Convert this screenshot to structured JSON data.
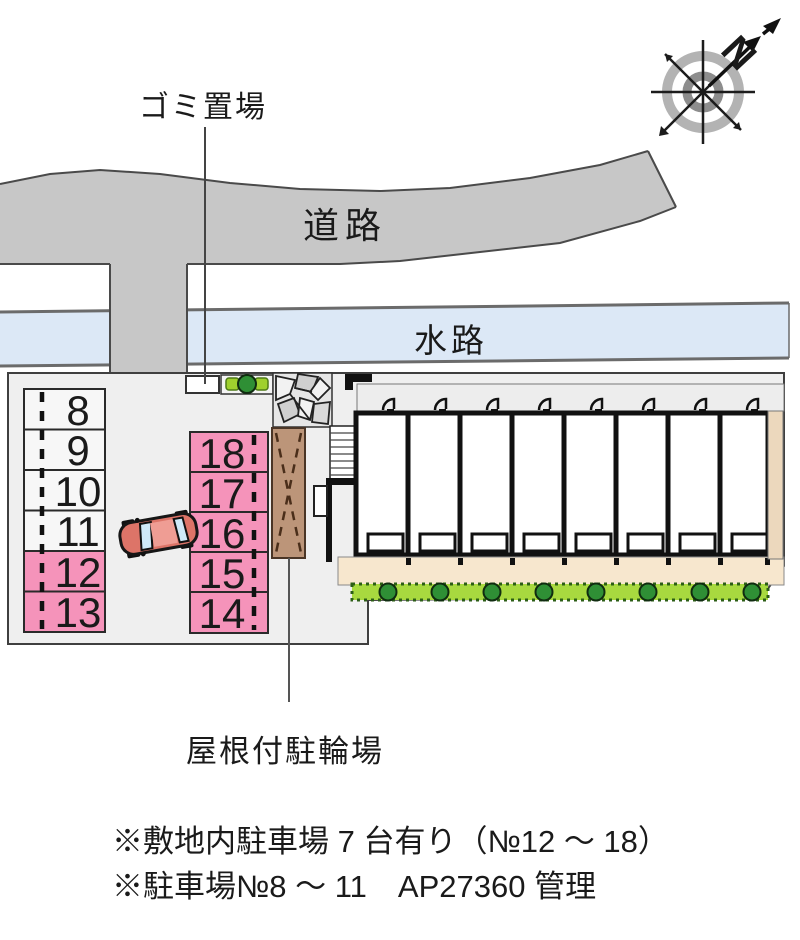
{
  "labels": {
    "garbage": "ゴミ置場",
    "road": "道路",
    "waterway": "水路",
    "bike_parking": "屋根付駐輪場",
    "compass_north": "N"
  },
  "notes": {
    "line1": "※敷地内駐車場 7 台有り（№12 ～ 18）",
    "line2": "※駐車場№8 ～ 11　AP27360 管理"
  },
  "parking": {
    "left_column": [
      {
        "no": "8",
        "highlighted": false
      },
      {
        "no": "9",
        "highlighted": false
      },
      {
        "no": "10",
        "highlighted": false
      },
      {
        "no": "11",
        "highlighted": false
      },
      {
        "no": "12",
        "highlighted": true
      },
      {
        "no": "13",
        "highlighted": true
      }
    ],
    "right_column": [
      {
        "no": "18",
        "highlighted": true
      },
      {
        "no": "17",
        "highlighted": true
      },
      {
        "no": "16",
        "highlighted": true
      },
      {
        "no": "15",
        "highlighted": true
      },
      {
        "no": "14",
        "highlighted": true
      }
    ]
  },
  "building": {
    "unit_count": 8
  },
  "colors": {
    "road": "#c7c7c7",
    "waterway": "#dce8f6",
    "site": "#efefef",
    "parking_highlight": "#f593ba",
    "parking_normal": "#f7f7f7",
    "hedge": "#a8d93f",
    "tree": "#2f8f35",
    "bush": "#9fd02e",
    "bike_shed": "#bc9579",
    "walkway": "#f7e7ce",
    "right_strip": "#ecd8bd"
  }
}
